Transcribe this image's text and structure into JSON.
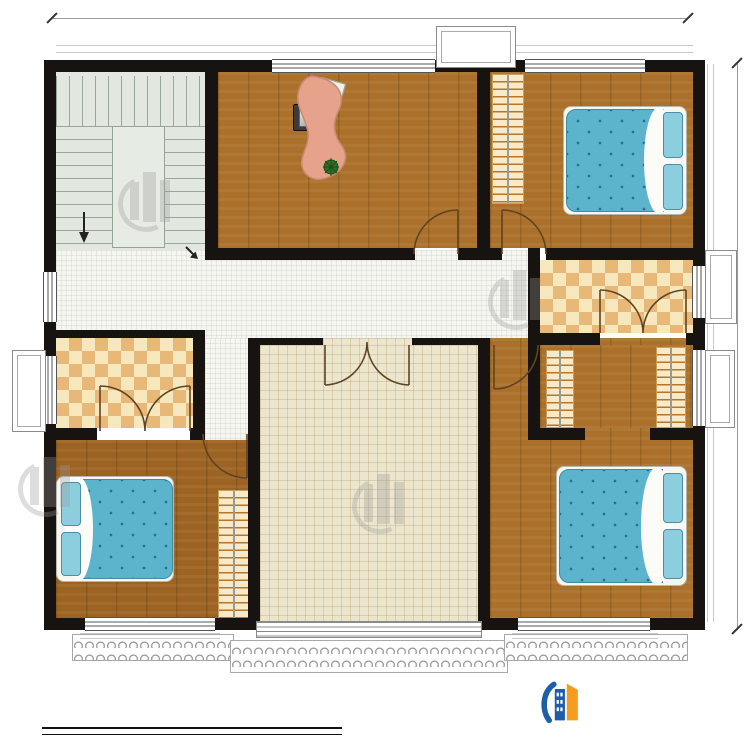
{
  "dimensions": {
    "top": "13200",
    "right": "11700"
  },
  "rooms": {
    "office": {
      "name": "办公室",
      "area": "18.89m²"
    },
    "bedroom_ne": {
      "name": "卧室",
      "area": "14.49m²"
    },
    "stair_hall": {
      "name": "楼梯间",
      "area": "18.35m²"
    },
    "hall": {
      "area": "10.45m²"
    },
    "corridor": {
      "area": "1.78m²"
    },
    "public_bath": {
      "name": "公卫",
      "area": "4.67m²"
    },
    "inner_bath": {
      "name": "内卫",
      "area": "4.34m²"
    },
    "cloakroom": {
      "name": "衣帽间",
      "area": "4.67m²"
    },
    "bedroom_sw": {
      "name": "卧室",
      "area": "15.68m²"
    },
    "bedroom_se": {
      "name": "卧室",
      "area": "17.94m²"
    },
    "terrace": {
      "name": "露台"
    }
  },
  "annotations": {
    "stair_down": "下"
  },
  "titleblock": {
    "title": "二层平面图",
    "scale": "1:100",
    "area_label": "本层建筑面积：",
    "area_value": "133.88m²",
    "floor_height_label": "层高：",
    "floor_height_value": "3.3m"
  },
  "brand": {
    "name": "柏竣建筑",
    "url": "www.baijunjz.com"
  },
  "colors": {
    "wall": "#171310",
    "wood": "#ab7029",
    "wood_dark": "#9c6322",
    "stair": "#e2e7e0",
    "hall": "#f6f6f1",
    "terrace": "#ede6cf",
    "tile_light": "#f7e7bd",
    "tile_dark": "#e7b877",
    "bed_blue": "#5cb4cc",
    "nightstand": "#e2854f",
    "desk": "#e7a28c",
    "logo_blue": "#1c5fa8",
    "logo_orange": "#f59b20",
    "url_red": "#e60012"
  }
}
